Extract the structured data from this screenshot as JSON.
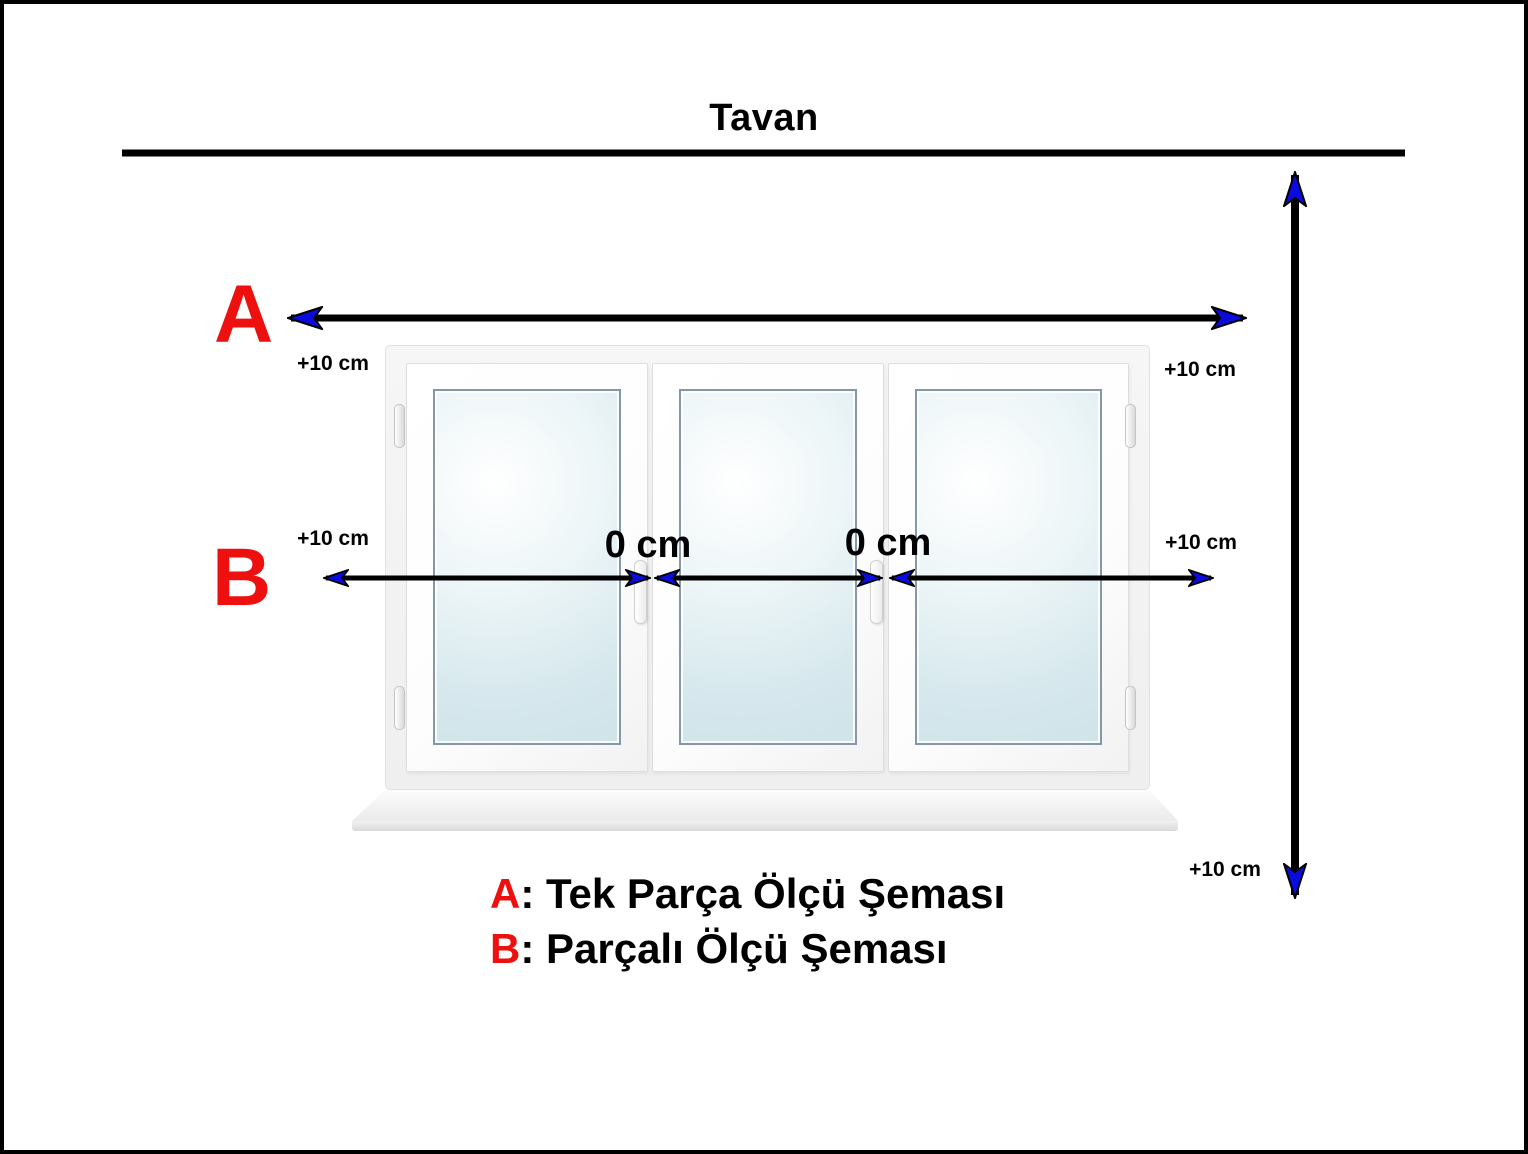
{
  "title": "Tavan",
  "scheme_labels": {
    "a": "A",
    "b": "B"
  },
  "measurements": {
    "a_left": "+10 cm",
    "a_right": "+10 cm",
    "b_left": "+10 cm",
    "b_right": "+10 cm",
    "height_bottom": "+10 cm",
    "gap_left": "0 cm",
    "gap_right": "0 cm"
  },
  "legend": {
    "items": [
      {
        "key": "A",
        "rest": ": Tek Parça Ölçü Şeması"
      },
      {
        "key": "B",
        "rest": ": Parçalı Ölçü Şeması"
      }
    ]
  },
  "window": {
    "pane_count": 3
  },
  "colors": {
    "accent_red": "#ee0f0f",
    "arrow_blue": "#0b0be0",
    "line_black": "#000000"
  }
}
